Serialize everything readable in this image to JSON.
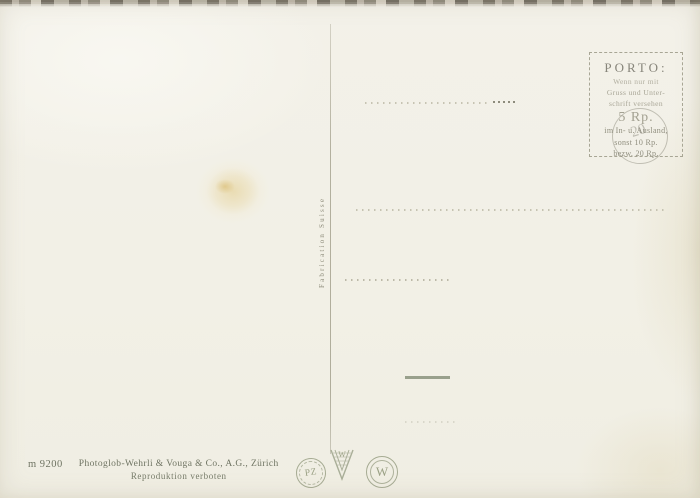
{
  "postcard": {
    "porto": {
      "title": "PORTO:",
      "condition_lines": [
        "Wenn nur mit",
        "Gruss und Unter-",
        "schrift versehen"
      ],
      "rate": "5 Rp.",
      "detail_lines": [
        "im In- u. Ausland,",
        "sonst 10 Rp.",
        "bezw. 20 Rp."
      ],
      "postmark_numeral": "20"
    },
    "divider_label": "Fabrication Suisse",
    "publisher": {
      "number": "m 9200",
      "name": "Photoglob-Wehrli & Vouga & Co., A.G., Zürich",
      "notice": "Reproduktion verboten"
    },
    "logos": {
      "left_badge": "PZ",
      "center_badge": "W",
      "right_badge": "W"
    },
    "colors": {
      "paper": "#f2f0e6",
      "imprint_ink": "#6f7463",
      "faded_ink": "#a6ab93",
      "stain": "#dec06a"
    }
  }
}
